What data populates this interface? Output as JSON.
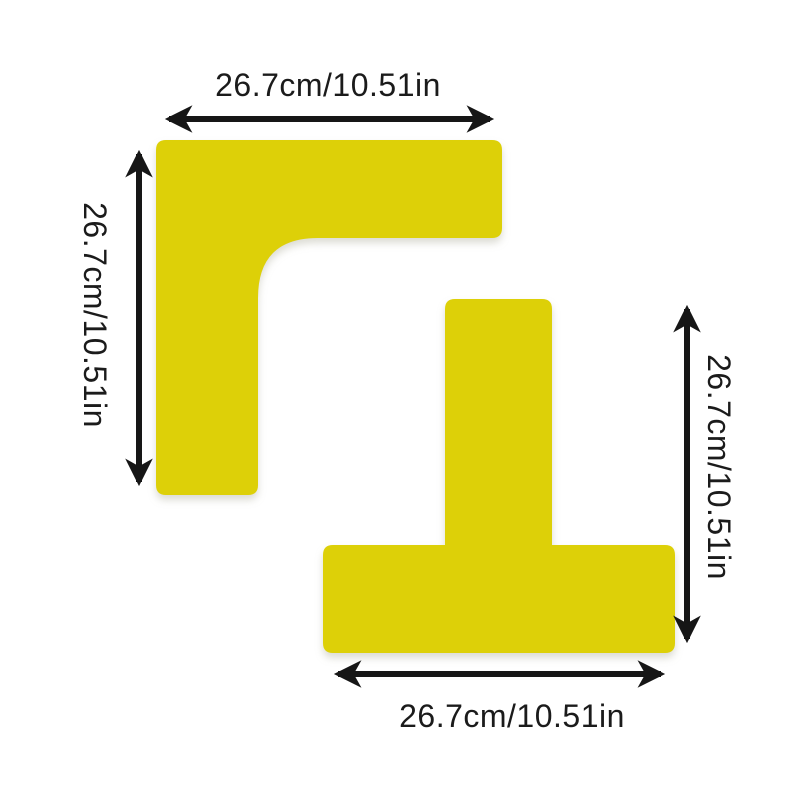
{
  "diagram": {
    "background_color": "#ffffff",
    "shape_color": "#ddd008",
    "arrow_color": "#161616",
    "label_color": "#1b1b1b",
    "l_marker": {
      "shape": "L-corner-marker",
      "width_label": "26.7cm/10.51in",
      "height_label": "26.7cm/10.51in"
    },
    "t_marker": {
      "shape": "T-marker",
      "width_label": "26.7cm/10.51in",
      "height_label": "26.7cm/10.51in"
    }
  }
}
